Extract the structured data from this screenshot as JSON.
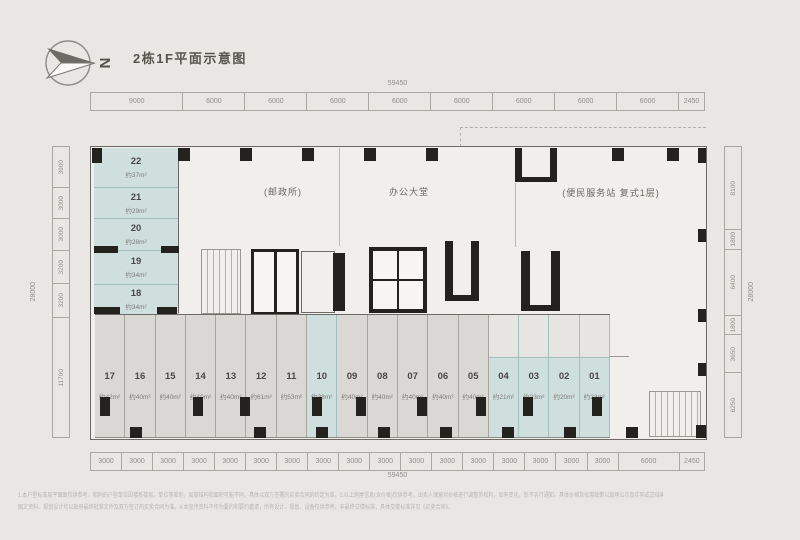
{
  "title": "2栋1F平面示意图",
  "compass": {
    "label": "N"
  },
  "plan": {
    "areas": {
      "post_office": "(邮政所)",
      "lobby": "办公大堂",
      "service": "(便民服务站 复式1层)"
    },
    "left_units": [
      {
        "no": "22",
        "area": "约37m²"
      },
      {
        "no": "21",
        "area": "约29m²"
      },
      {
        "no": "20",
        "area": "约28m²"
      },
      {
        "no": "19",
        "area": "约34m²"
      },
      {
        "no": "18",
        "area": "约34m²"
      }
    ],
    "bottom_units": [
      {
        "no": "17",
        "area": "约42m²",
        "teal": false
      },
      {
        "no": "16",
        "area": "约40m²",
        "teal": false
      },
      {
        "no": "15",
        "area": "约40m²",
        "teal": false
      },
      {
        "no": "14",
        "area": "约40m²",
        "teal": false
      },
      {
        "no": "13",
        "area": "约40m²",
        "teal": false
      },
      {
        "no": "12",
        "area": "约61m²",
        "teal": false
      },
      {
        "no": "11",
        "area": "约53m²",
        "teal": false
      },
      {
        "no": "10",
        "area": "约38m²",
        "teal": true
      },
      {
        "no": "09",
        "area": "约40m²",
        "teal": false
      },
      {
        "no": "08",
        "area": "约40m²",
        "teal": false
      },
      {
        "no": "07",
        "area": "约40m²",
        "teal": false
      },
      {
        "no": "06",
        "area": "约40m²",
        "teal": false
      },
      {
        "no": "05",
        "area": "约40m²",
        "teal": false
      },
      {
        "no": "04",
        "area": "约21m²",
        "teal": true
      },
      {
        "no": "03",
        "area": "约23m²",
        "teal": true
      },
      {
        "no": "02",
        "area": "约20m²",
        "teal": true
      },
      {
        "no": "01",
        "area": "约23m²",
        "teal": true
      }
    ]
  },
  "dimensions": {
    "top": {
      "total": "59450",
      "segments": [
        "9000",
        "6000",
        "6000",
        "6000",
        "6000",
        "6000",
        "6000",
        "6000",
        "6000",
        "2450"
      ]
    },
    "bottom": {
      "total": "59450",
      "segments": [
        "3000",
        "3000",
        "3000",
        "3000",
        "3000",
        "3000",
        "3000",
        "3000",
        "3000",
        "3000",
        "3000",
        "3000",
        "3000",
        "3000",
        "3000",
        "3000",
        "3000",
        "6000",
        "2450"
      ]
    },
    "left": {
      "total": "28000",
      "segments": [
        "3900",
        "3000",
        "3000",
        "3200",
        "3200",
        "11700"
      ]
    },
    "right": {
      "total": "28000",
      "segments": [
        "8100",
        "1800",
        "6400",
        "1800",
        "3650",
        "6250"
      ]
    }
  },
  "colors": {
    "teal": "#cfdfde",
    "unit_gray": "#d9d8d5",
    "wall_black": "#24221f",
    "background": "#e9e7e4"
  },
  "disclaimer": {
    "line1": "1.本户型标准层平面图仅供参考，相同的户型单位因楼栋楼层、单位等差别，局部结构和面积可能不同，具体以双方签署的买卖合同的约定为准。2.以上房屋信息(含价格)仅供参考，出卖人保留对价格进行调整的权利，如有变化，恕不另行通知，具体价格及优惠政策以现场公示及实际成交结果为准。3.本项目相关文字、",
    "line2": "图文资料、规划设计均以政府最终批准文件及双方签订的买卖合同为准。4.本宣传资料不作为要约和要约邀请，所有设计、规划、设备仅供参考，非最终交楼标准，具体交楼标准详见《买卖合同》。"
  }
}
